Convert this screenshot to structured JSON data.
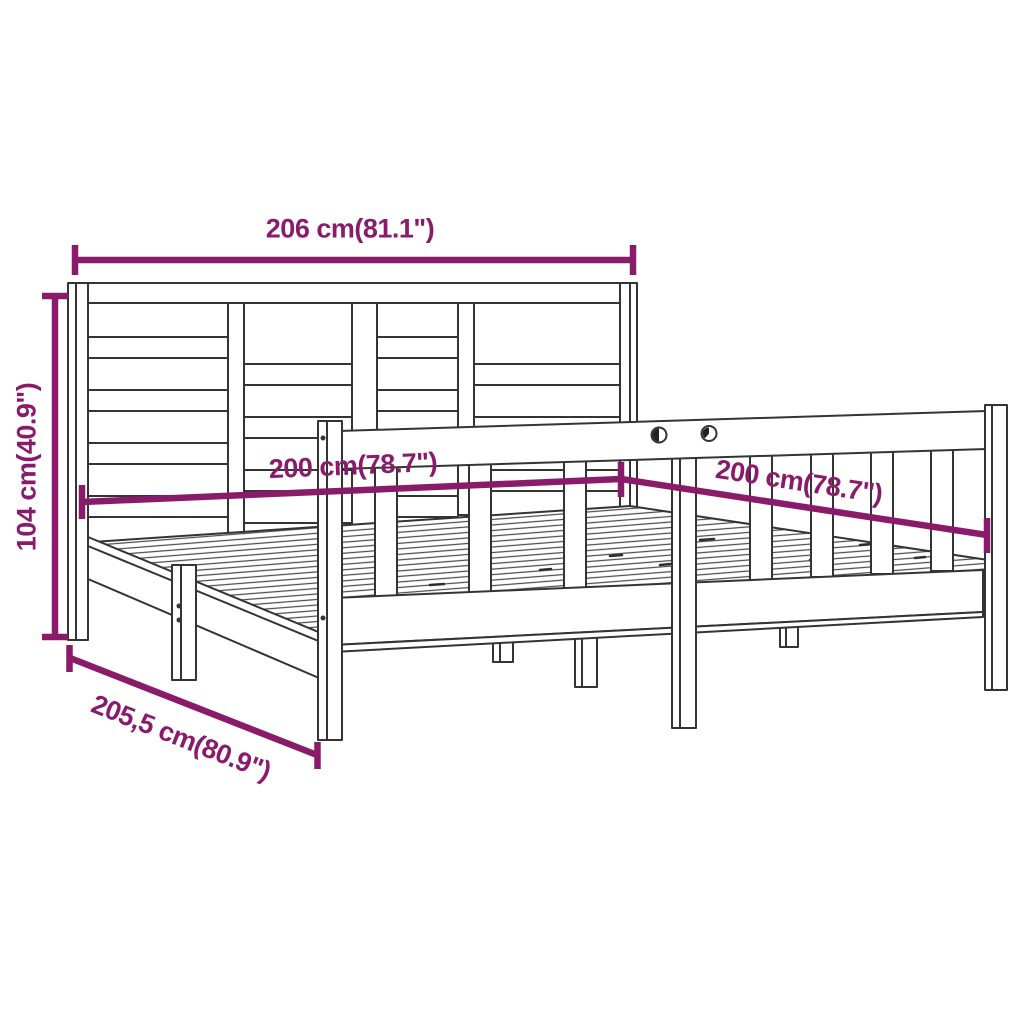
{
  "diagram": {
    "dimension_color": "#8a1b6b",
    "line_color": "#343434",
    "background_color": "#ffffff",
    "dimensions": {
      "width": "206 cm(81.1\")",
      "height": "104 cm(40.9\")",
      "mattress_left": "200 cm(78.7\")",
      "mattress_right": "200 cm(78.7\")",
      "depth": "205,5 cm(80.9\")"
    }
  }
}
